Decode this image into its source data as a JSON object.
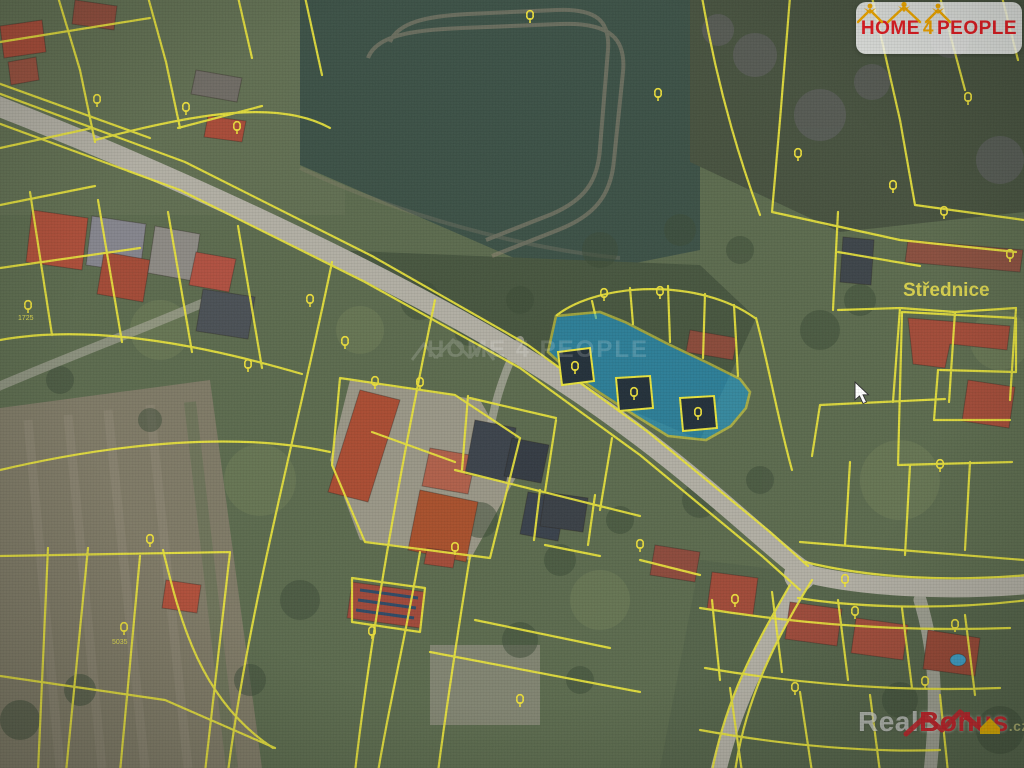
{
  "map": {
    "place_label": "Střednice",
    "parcel_labels": [
      "1725",
      "5035"
    ],
    "highlighted_parcel": {
      "fill": "#17a0e0",
      "border": "#eae43c"
    },
    "parcel_line_color": "#eae43c",
    "road_color": "#b2afa4"
  },
  "logo": {
    "word1": "HOME",
    "word2": "4",
    "word3": "PEOPLE",
    "text_color": "#e31e24",
    "number_color": "#f0a500",
    "icon": "home4people-houses-icon"
  },
  "watermark_center": {
    "text": "HOME 4 PEOPLE"
  },
  "watermark_bottom": {
    "part1": "Real",
    "part2": "Bonus",
    "suffix": ".cz",
    "icon": "realbonus-roof-icon"
  },
  "cursor": {
    "type": "arrow-pointer"
  }
}
